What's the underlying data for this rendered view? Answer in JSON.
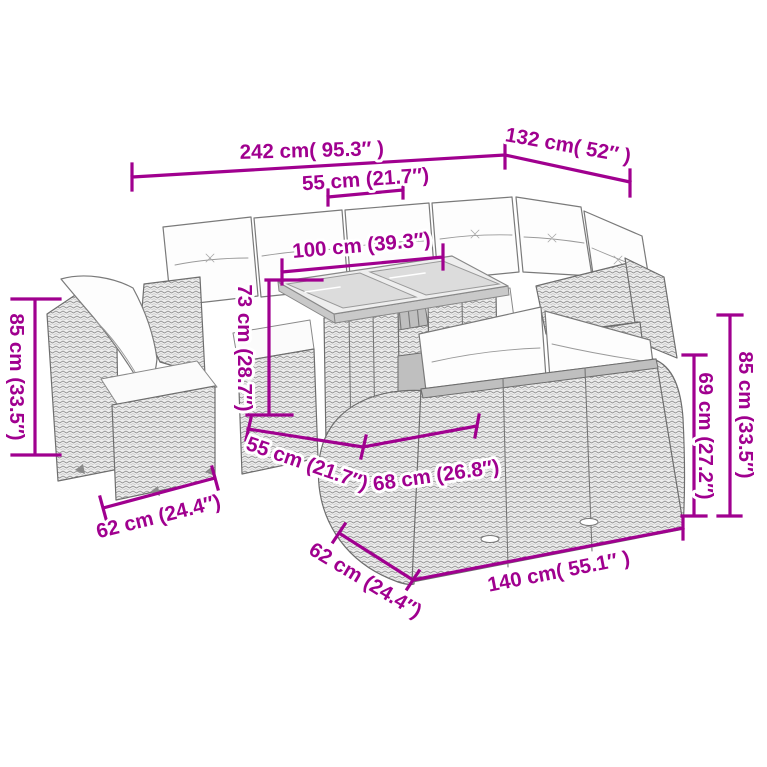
{
  "colors": {
    "dimension_accent": "#A0008F",
    "sketch_line": "#777777",
    "background": "#FFFFFF"
  },
  "image_type": "furniture-dimension-diagram",
  "dimensions": [
    {
      "id": "back-sofa-total-width",
      "label": "242 cm( 95.3″ )"
    },
    {
      "id": "corner-right-width",
      "label": "132 cm( 52″ )"
    },
    {
      "id": "back-seat-width",
      "label": "55 cm (21.7″)"
    },
    {
      "id": "table-length",
      "label": "100 cm (39.3″)"
    },
    {
      "id": "table-height",
      "label": "73 cm (28.7″)"
    },
    {
      "id": "armchair-height",
      "label": "85 cm (33.5″)"
    },
    {
      "id": "front-seat-width",
      "label": "55 cm (21.7″)"
    },
    {
      "id": "front-seat-depth",
      "label": "68 cm (26.8″)"
    },
    {
      "id": "armchair-depth",
      "label": "62 cm (24.4″)"
    },
    {
      "id": "sofa-back-height",
      "label": "85 cm (33.5″)"
    },
    {
      "id": "sofa-arm-height",
      "label": "69 cm (27.2″)"
    },
    {
      "id": "sofa-depth",
      "label": "62 cm (24.4″)"
    },
    {
      "id": "sofa-width",
      "label": "140 cm( 55.1″ )"
    }
  ]
}
